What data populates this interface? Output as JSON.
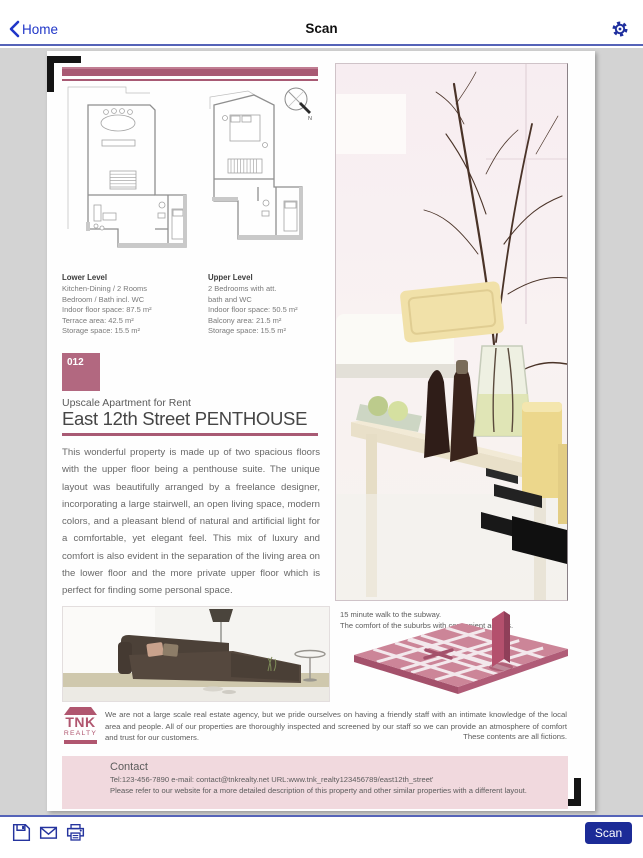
{
  "navbar": {
    "back_label": "Home",
    "title": "Scan"
  },
  "toolbar": {
    "scan_label": "Scan"
  },
  "colors": {
    "accent_rose": "#a85a74",
    "badge_rose": "#b26880",
    "contact_pink": "#f1d9de",
    "map_pink": "#cc8598",
    "nav_blue": "#2036c8",
    "button_blue": "#1c2b97",
    "stage_gray": "#d3d3d3"
  },
  "document": {
    "plans": {
      "compass_label": "N",
      "lower": {
        "heading": "Lower Level",
        "lines": [
          "Kitchen-Dining / 2 Rooms",
          "Bedroom / Bath incl. WC",
          "Indoor floor space: 87.5 m²",
          "Terrace area: 42.5 m²",
          "Storage space: 15.5 m²"
        ]
      },
      "upper": {
        "heading": "Upper Level",
        "lines": [
          "2 Bedrooms with att.",
          "bath and WC",
          "Indoor floor space: 50.5 m²",
          "Balcony area: 21.5 m²",
          "Storage space: 15.5 m²"
        ]
      }
    },
    "listing": {
      "number": "012",
      "subtitle": "Upscale Apartment for Rent",
      "title": "East 12th Street PENTHOUSE",
      "description": "This wonderful property is made up of two spacious floors with the upper floor being a penthouse suite. The unique layout was beautifully arranged by a freelance designer, incorporating a large stairwell, an open living space, modern colors, and a pleasant blend of natural and artificial light for a comfortable, yet elegant feel. This mix of luxury and comfort is also evident in the separation of the living area on the lower floor and the more private upper floor which is perfect for finding some personal space."
    },
    "location": {
      "line1": "15 minute walk to the subway.",
      "line2": "The comfort of the suburbs with convenient access."
    },
    "agency": {
      "logo_line1": "TNK",
      "logo_line2": "REALTY",
      "blurb": "We are not a large scale real estate agency, but we pride ourselves on having a friendly staff with an intimate knowledge of the local area and people. All of our properties are thoroughly inspected and screened by our staff so we can provide an atmosphere of comfort and trust for our customers.",
      "disclaimer": "These contents are all fictions."
    },
    "contact": {
      "heading": "Contact",
      "line1": "Tel:123-456-7890  e-mail: contact@tnkrealty.net URL:www.tnk_realty123456789/east12th_street'",
      "line2": "Please refer to our website for a more detailed description of this property and other similar properties with a different layout."
    }
  }
}
